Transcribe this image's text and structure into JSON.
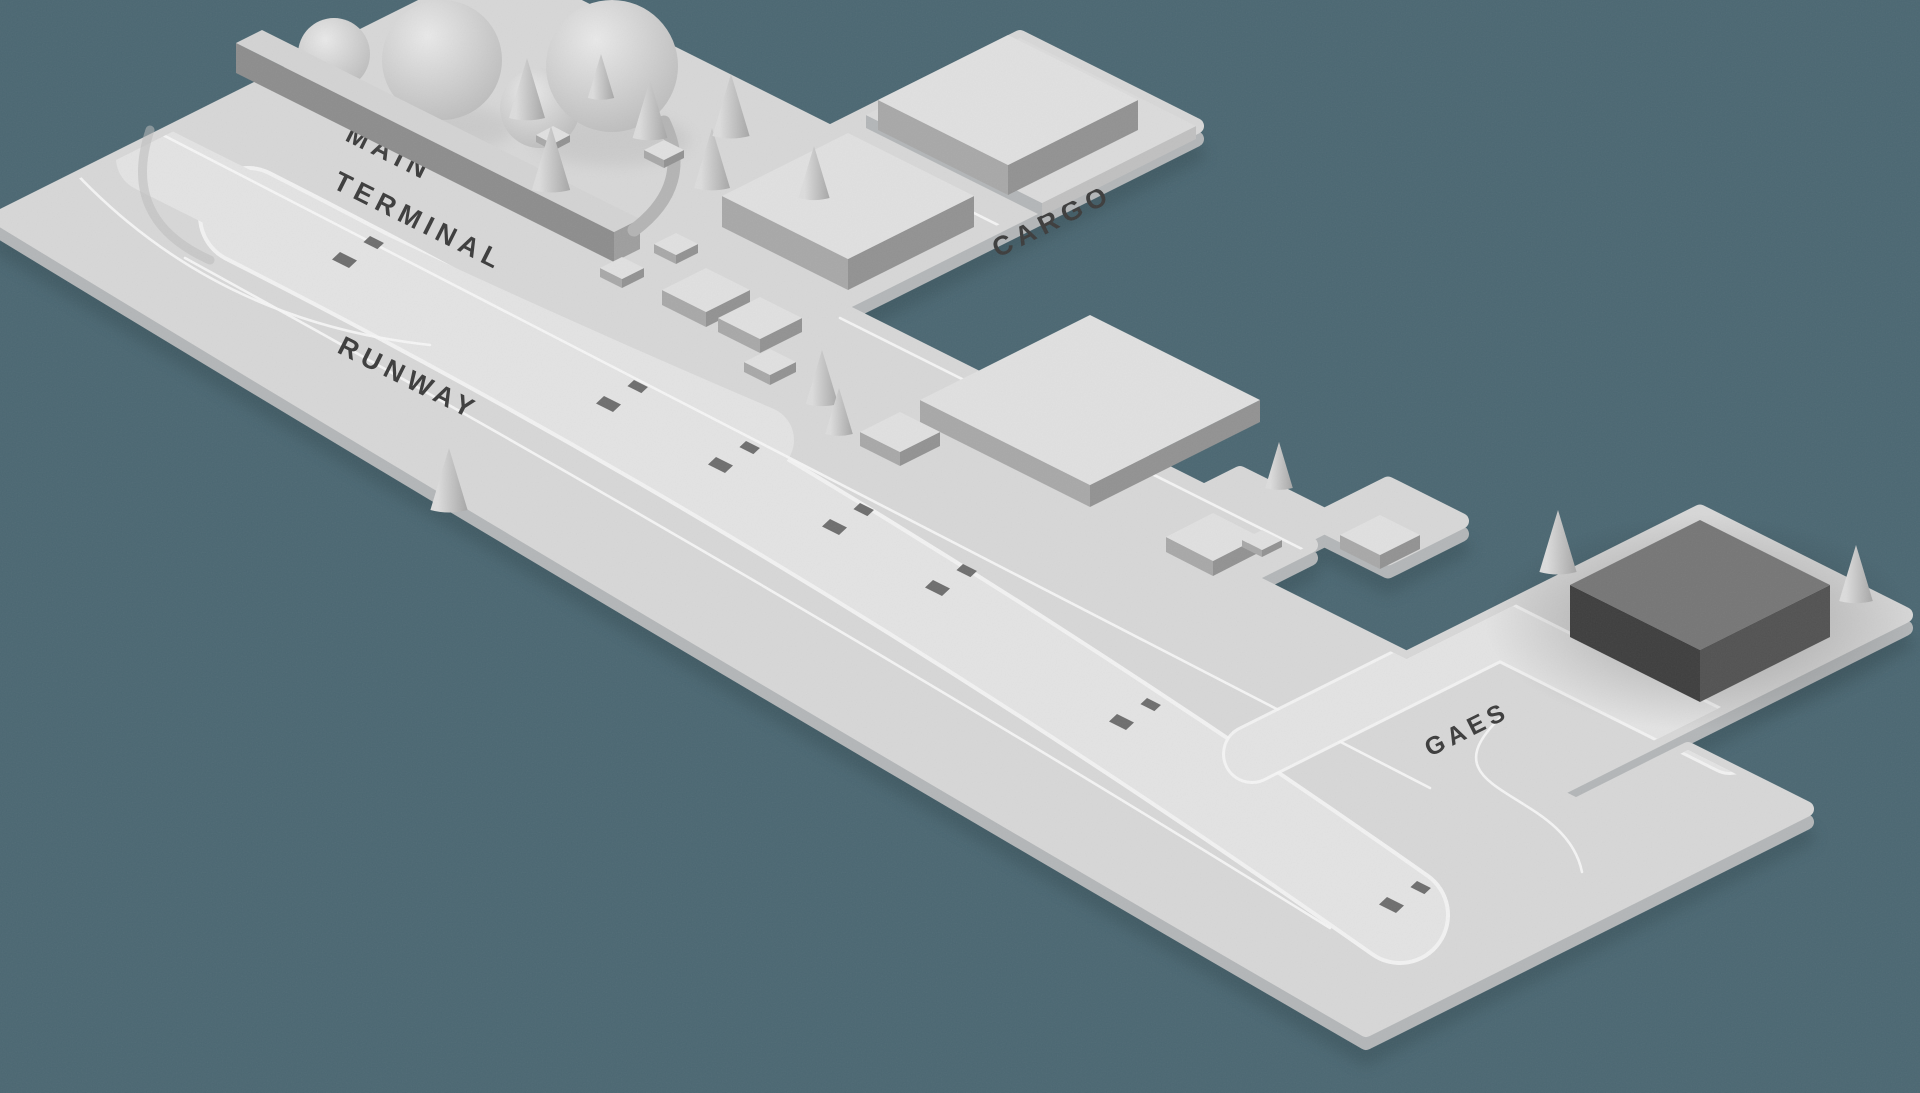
{
  "scene": {
    "type": "isometric-airport-map",
    "labels": {
      "main_terminal_line1": "MAIN",
      "main_terminal_line2": "TERMINAL",
      "cargo": "CARGO",
      "runway": "RUNWAY",
      "gaes": "GAES"
    },
    "zones": [
      {
        "id": "main-terminal",
        "label": "MAIN TERMINAL"
      },
      {
        "id": "cargo",
        "label": "CARGO"
      },
      {
        "id": "runway",
        "label": "RUNWAY"
      },
      {
        "id": "gaes",
        "label": "GAES"
      }
    ],
    "colors": {
      "bg": "#4b6772",
      "land": "#d7d7d7",
      "land2": "#e0e0e0",
      "strip": "#e3e3e3",
      "road": "#f5f5f5",
      "skirt": "#b3b6b8",
      "shadow": "#2f444c",
      "bar-top": "#d3d3d3",
      "bar-side": "#8d8d8d",
      "bar-end": "#9e9e9e",
      "bldg-top": "#e0e0e0",
      "wall-sw": "#a8a8a8",
      "wall-se": "#929292",
      "plateau": "#dbdbdb",
      "plateau-wall": "#c0c0c0",
      "dark-top": "#767676",
      "dark-sw": "#3e3e3e",
      "dark-se": "#525252",
      "label": "#3c3c3c",
      "dash": "#6e6e6e",
      "dome-hi": "#e9e9e9",
      "dome-lo": "#bcbcbc",
      "cone-hi": "#dcdcdc",
      "cone-lo": "#a6a6a6"
    }
  }
}
